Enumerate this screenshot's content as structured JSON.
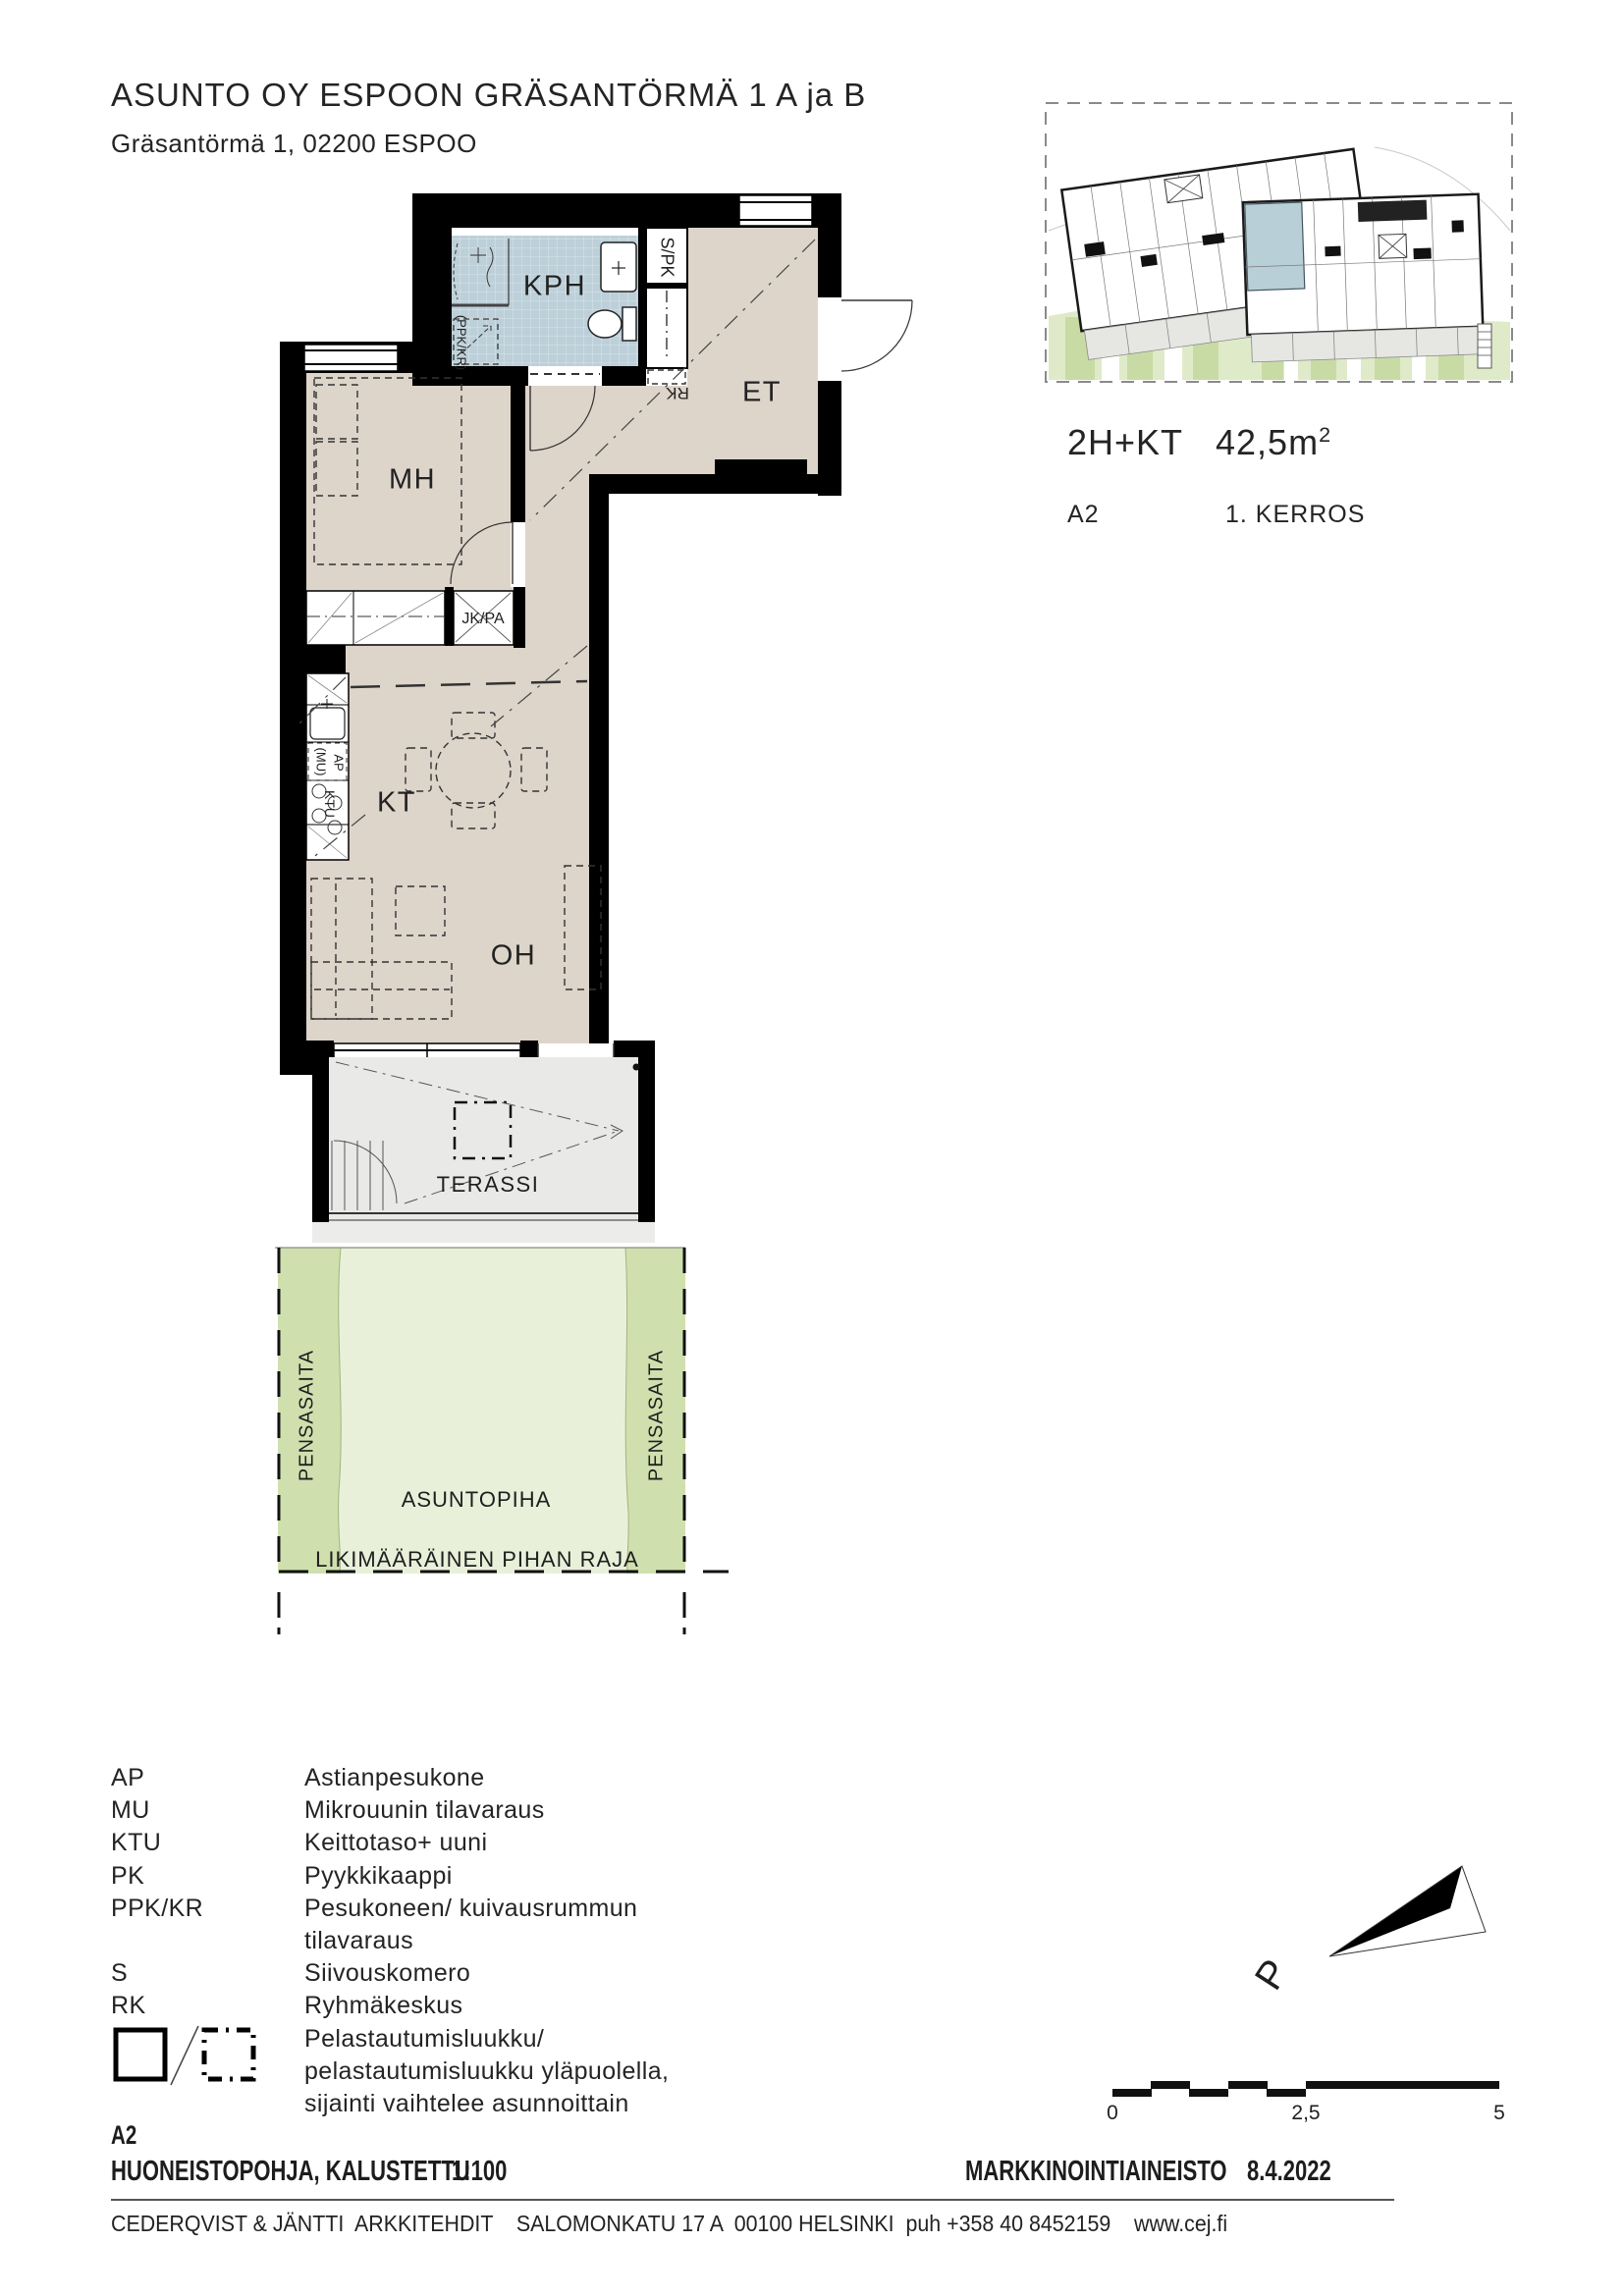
{
  "header": {
    "title": "ASUNTO OY ESPOON GRÄSANTÖRMÄ 1 A ja B",
    "address": "Gräsantörmä 1, 02200 ESPOO"
  },
  "summary": {
    "type": "2H+KT",
    "area": "42,5m",
    "area_exponent": "2",
    "unit": "A2",
    "floor": "1. KERROS"
  },
  "plan": {
    "rooms": {
      "kph": "KPH",
      "et": "ET",
      "mh": "MH",
      "kt": "KT",
      "oh": "OH",
      "terrace": "TERASSI"
    },
    "labels": {
      "spk": "S/PK",
      "rk": "RK",
      "jk_pa": "JK/PA",
      "ppk_kr": "(PPK/KR)",
      "mu": "(MU)",
      "ap": "AP",
      "ktu": "KTU"
    },
    "yard": {
      "hedge_left": "PENSASAITA",
      "hedge_right": "PENSASAITA",
      "courtyard": "ASUNTOPIHA",
      "boundary": "LIKIMÄÄRÄINEN PIHAN RAJA"
    }
  },
  "legend": {
    "rows": [
      {
        "code": "AP",
        "text": "Astianpesukone"
      },
      {
        "code": "MU",
        "text": "Mikrouunin tilavaraus"
      },
      {
        "code": "KTU",
        "text": "Keittotaso+ uuni"
      },
      {
        "code": "PK",
        "text": "Pyykkikaappi"
      },
      {
        "code": "PPK/KR",
        "text": "Pesukoneen/ kuivausrummun"
      },
      {
        "code": "",
        "text": "tilavaraus"
      },
      {
        "code": "S",
        "text": "Siivouskomero"
      },
      {
        "code": "RK",
        "text": "Ryhmäkeskus"
      },
      {
        "code": "",
        "text": "Pelastautumisluukku/"
      },
      {
        "code": "",
        "text": "pelastautumisluukku yläpuolella,"
      },
      {
        "code": "",
        "text": "sijainti vaihtelee asunnoittain"
      }
    ]
  },
  "titleblock": {
    "unit": "A2",
    "drawing_title": "HUONEISTOPOHJA, KALUSTETTU",
    "scale": "1:100",
    "material": "MARKKINOINTIAINEISTO",
    "date": "8.4.2022"
  },
  "footer": {
    "line": "CEDERQVIST & JÄNTTI  ARKKITEHDIT    SALOMONKATU 17 A  00100 HELSINKI  puh +358 40 8452159    www.cej.fi"
  },
  "compass": {
    "north": "P"
  },
  "scalebar": {
    "zero": "0",
    "mid": "2,5",
    "max": "5"
  },
  "colors": {
    "floor": "#ddd4ca",
    "bath": "#bdd0d9",
    "terrace": "#e9e9e7",
    "hedge": "#cfe0ae",
    "courtyard": "#e9f0da",
    "wall": "#000000",
    "site_unit": "#b9cfd8"
  }
}
